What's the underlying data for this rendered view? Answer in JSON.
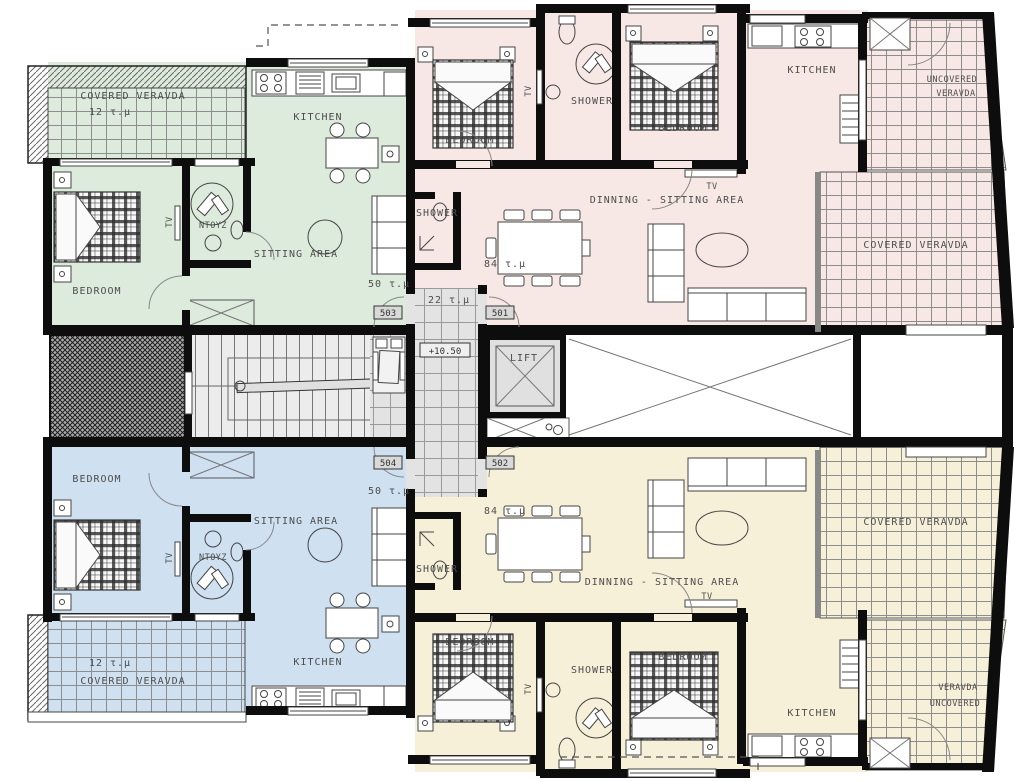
{
  "colors": {
    "unit_503": "#dcebdb",
    "unit_501": "#f7e8e5",
    "unit_504": "#cfe0f1",
    "unit_502": "#f7f0d8",
    "core_floor": "#ececec",
    "wall": "#0d0d0d"
  },
  "core": {
    "lift": "LIFT",
    "level": "+10.50",
    "corridor_area": "22 τ.μ"
  },
  "units": {
    "u503": {
      "number": "503",
      "area": "50 τ.μ",
      "bedroom": "BEDROOM",
      "kitchen": "KITCHEN",
      "sitting": "SITTING AREA",
      "shower": "ΝΤΟΥΖ",
      "tv": "TV",
      "veranda": "COVERED VERAVDA",
      "veranda_area": "12 τ.μ"
    },
    "u501": {
      "number": "501",
      "area": "84 τ.μ",
      "bedroom1": "BEDROOM",
      "bedroom2": "BEDROOM",
      "shower1": "SHOWER",
      "shower2": "SHOWER",
      "kitchen": "KITCHEN",
      "living": "DINNING - SITTING AREA",
      "tv": "TV",
      "covered_veranda": "COVERED VERAVDA",
      "uncovered_line1": "UNCOVERED",
      "uncovered_line2": "VERAVDA"
    },
    "u504": {
      "number": "504",
      "area": "50 τ.μ",
      "bedroom": "BEDROOM",
      "kitchen": "KITCHEN",
      "sitting": "SITTING AREA",
      "shower": "ΝΤΟΥΖ",
      "tv": "TV",
      "veranda": "COVERED VERAVDA",
      "veranda_area": "12 τ.μ"
    },
    "u502": {
      "number": "502",
      "area": "84 τ.μ",
      "bedroom1": "BEDROOM",
      "bedroom2": "BEDROOM",
      "shower1": "SHOWER",
      "shower2": "SHOWER",
      "kitchen": "KITCHEN",
      "living": "DINNING - SITTING AREA",
      "tv": "TV",
      "covered_veranda": "COVERED VERAVDA",
      "uncovered_line1": "VERAVDA",
      "uncovered_line2": "UNCOVERED"
    }
  }
}
